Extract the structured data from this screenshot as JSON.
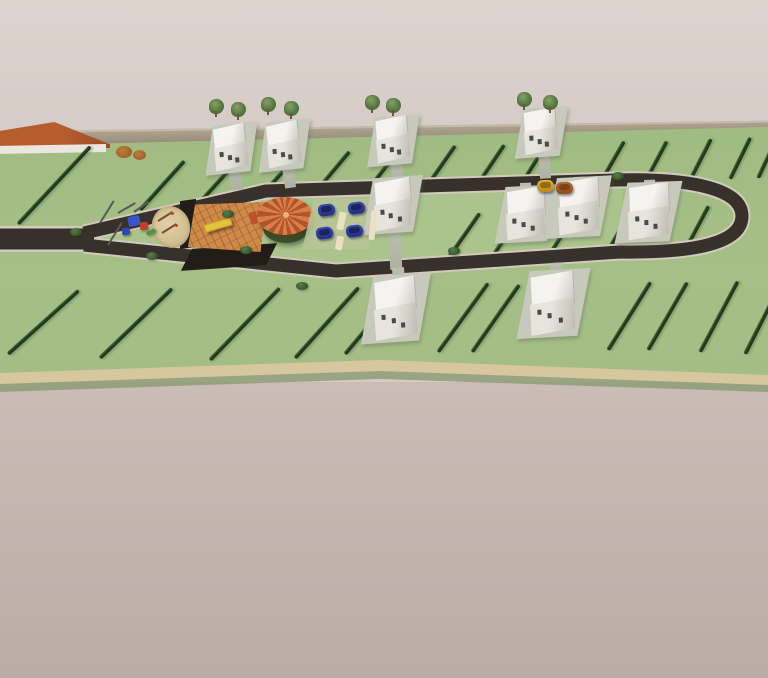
{
  "meta": {
    "description": "Aerial 3D architectural render of a residential subdivision: a looped dark asphalt road through green fenced lots, white two-storey houses, a central park with playground, sand pit, wooden deck, orange-roofed gazebo and parking with blue cars, bounded by a perimeter wall on a pale mauve ground."
  },
  "palette": {
    "background_top": "#d8cec9",
    "ground_bottom": "#c4b5af",
    "lot_green": "#a2bc84",
    "park_green": "#abc38c",
    "hedge_green": "#27431f",
    "road_asphalt": "#38312b",
    "road_curb": "#d2cabc",
    "perimeter_wall": "#aca28e",
    "path_tan": "#d6c79e",
    "house_white": "#f2f0ec",
    "gazebo_roof_orange": "#c96c3a",
    "deck_orange": "#cf8a49",
    "bench_yellow": "#e6c23c",
    "car_blue": "#2c3a96",
    "car_yellow": "#d8a61f",
    "neighbour_roof_orange": "#b0582a",
    "sand_tan": "#dcc89c"
  },
  "scene": {
    "counts": {
      "houses": 10,
      "blue_cars": 4,
      "road_cars": 2,
      "trees": 8,
      "gazebos": 1,
      "playgrounds": 1
    },
    "houses": [
      {
        "x": 214,
        "y": 127,
        "w": 34,
        "h": 42,
        "rot": -6
      },
      {
        "x": 267,
        "y": 124,
        "w": 34,
        "h": 42,
        "rot": -6
      },
      {
        "x": 376,
        "y": 119,
        "w": 34,
        "h": 42,
        "rot": -5
      },
      {
        "x": 524,
        "y": 111,
        "w": 34,
        "h": 42,
        "rot": -4
      },
      {
        "x": 374,
        "y": 181,
        "w": 38,
        "h": 48,
        "rot": -4
      },
      {
        "x": 506,
        "y": 190,
        "w": 40,
        "h": 48,
        "rot": -3
      },
      {
        "x": 558,
        "y": 181,
        "w": 42,
        "h": 52,
        "rot": -3
      },
      {
        "x": 628,
        "y": 186,
        "w": 42,
        "h": 52,
        "rot": -2
      },
      {
        "x": 374,
        "y": 280,
        "w": 44,
        "h": 58,
        "rot": -4
      },
      {
        "x": 530,
        "y": 275,
        "w": 46,
        "h": 58,
        "rot": -3
      }
    ],
    "driveways": [
      {
        "x": 228,
        "y": 165,
        "w": 11,
        "h": 26,
        "rot": -10
      },
      {
        "x": 281,
        "y": 162,
        "w": 11,
        "h": 27,
        "rot": -9
      },
      {
        "x": 390,
        "y": 157,
        "w": 11,
        "h": 27,
        "rot": -6
      },
      {
        "x": 538,
        "y": 149,
        "w": 11,
        "h": 30,
        "rot": -4
      },
      {
        "x": 388,
        "y": 226,
        "w": 12,
        "h": 44,
        "rot": -3
      },
      {
        "x": 520,
        "y": 183,
        "w": 11,
        "h": 10,
        "rot": -2
      },
      {
        "x": 574,
        "y": 177,
        "w": 11,
        "h": 8,
        "rot": -2
      },
      {
        "x": 644,
        "y": 180,
        "w": 11,
        "h": 9,
        "rot": -2
      },
      {
        "x": 392,
        "y": 268,
        "w": 12,
        "h": 16,
        "rot": -4
      },
      {
        "x": 550,
        "y": 263,
        "w": 12,
        "h": 16,
        "rot": -3
      }
    ],
    "hedges": [
      {
        "x": 18,
        "y": 222,
        "len": 106,
        "rot": -47
      },
      {
        "x": 140,
        "y": 208,
        "len": 66,
        "rot": -48
      },
      {
        "x": 200,
        "y": 200,
        "len": 60,
        "rot": -48
      },
      {
        "x": 258,
        "y": 197,
        "len": 58,
        "rot": -48
      },
      {
        "x": 312,
        "y": 194,
        "len": 58,
        "rot": -50
      },
      {
        "x": 366,
        "y": 190,
        "len": 56,
        "rot": -52
      },
      {
        "x": 424,
        "y": 188,
        "len": 54,
        "rot": -55
      },
      {
        "x": 475,
        "y": 186,
        "len": 52,
        "rot": -56
      },
      {
        "x": 520,
        "y": 184,
        "len": 50,
        "rot": -58
      },
      {
        "x": 600,
        "y": 181,
        "len": 48,
        "rot": -60
      },
      {
        "x": 645,
        "y": 180,
        "len": 46,
        "rot": -62
      },
      {
        "x": 690,
        "y": 178,
        "len": 46,
        "rot": -63
      },
      {
        "x": 730,
        "y": 177,
        "len": 46,
        "rot": -64
      },
      {
        "x": 758,
        "y": 176,
        "len": 44,
        "rot": -65
      },
      {
        "x": 444,
        "y": 262,
        "len": 62,
        "rot": -55
      },
      {
        "x": 490,
        "y": 258,
        "len": 58,
        "rot": -56
      },
      {
        "x": 548,
        "y": 255,
        "len": 56,
        "rot": -58
      },
      {
        "x": 606,
        "y": 252,
        "len": 54,
        "rot": -60
      },
      {
        "x": 684,
        "y": 250,
        "len": 52,
        "rot": -62
      },
      {
        "x": 8,
        "y": 352,
        "len": 95,
        "rot": -42
      },
      {
        "x": 100,
        "y": 356,
        "len": 100,
        "rot": -44
      },
      {
        "x": 210,
        "y": 358,
        "len": 100,
        "rot": -46
      },
      {
        "x": 295,
        "y": 356,
        "len": 95,
        "rot": -48
      },
      {
        "x": 345,
        "y": 352,
        "len": 88,
        "rot": -50
      },
      {
        "x": 438,
        "y": 350,
        "len": 85,
        "rot": -54
      },
      {
        "x": 472,
        "y": 350,
        "len": 82,
        "rot": -55
      },
      {
        "x": 608,
        "y": 348,
        "len": 80,
        "rot": -58
      },
      {
        "x": 648,
        "y": 348,
        "len": 78,
        "rot": -60
      },
      {
        "x": 700,
        "y": 350,
        "len": 80,
        "rot": -62
      },
      {
        "x": 745,
        "y": 352,
        "len": 78,
        "rot": -63
      }
    ],
    "trees": [
      {
        "x": 209,
        "y": 99
      },
      {
        "x": 231,
        "y": 102
      },
      {
        "x": 261,
        "y": 97
      },
      {
        "x": 284,
        "y": 101
      },
      {
        "x": 365,
        "y": 95
      },
      {
        "x": 386,
        "y": 98
      },
      {
        "x": 517,
        "y": 92
      },
      {
        "x": 543,
        "y": 95
      }
    ],
    "bushes": [
      {
        "x": 70,
        "y": 228
      },
      {
        "x": 146,
        "y": 252
      },
      {
        "x": 222,
        "y": 210
      },
      {
        "x": 240,
        "y": 246
      },
      {
        "x": 448,
        "y": 247
      },
      {
        "x": 612,
        "y": 172
      },
      {
        "x": 296,
        "y": 282
      }
    ],
    "cars": [
      {
        "x": 318,
        "y": 204,
        "kind": "blue",
        "rot": -8
      },
      {
        "x": 348,
        "y": 202,
        "kind": "blue",
        "rot": -8
      },
      {
        "x": 316,
        "y": 227,
        "kind": "blue",
        "rot": -8
      },
      {
        "x": 346,
        "y": 225,
        "kind": "blue",
        "rot": -8
      },
      {
        "x": 537,
        "y": 180,
        "kind": "yellow",
        "rot": -2
      },
      {
        "x": 556,
        "y": 182,
        "kind": "rust",
        "rot": -2
      }
    ],
    "seesaws": [
      {
        "x": 158,
        "y": 220,
        "len": 17,
        "rot": -32
      },
      {
        "x": 162,
        "y": 232,
        "len": 17,
        "rot": -32
      }
    ],
    "frame_bars": [
      {
        "x": 100,
        "y": 222,
        "len": 26,
        "rot": -58
      },
      {
        "x": 108,
        "y": 244,
        "len": 26,
        "rot": -58
      },
      {
        "x": 118,
        "y": 212,
        "len": 20,
        "rot": -30
      },
      {
        "x": 134,
        "y": 211,
        "len": 18,
        "rot": -35
      }
    ],
    "play_blocks": [
      {
        "x": 128,
        "y": 216,
        "w": 12,
        "h": 10,
        "rot": -10,
        "color": "#3a55c8"
      },
      {
        "x": 140,
        "y": 222,
        "w": 8,
        "h": 8,
        "rot": -5,
        "color": "#c23e2e"
      },
      {
        "x": 122,
        "y": 228,
        "w": 8,
        "h": 7,
        "rot": -8,
        "color": "#2f48b0"
      },
      {
        "x": 146,
        "y": 230,
        "w": 10,
        "h": 4,
        "rot": -25,
        "color": "#4f9440"
      }
    ],
    "walks": [
      {
        "x": 338,
        "y": 212,
        "w": 7,
        "h": 18,
        "rot": 12
      },
      {
        "x": 336,
        "y": 236,
        "w": 7,
        "h": 14,
        "rot": 10
      },
      {
        "x": 370,
        "y": 210,
        "w": 6,
        "h": 30,
        "rot": 6
      }
    ]
  }
}
